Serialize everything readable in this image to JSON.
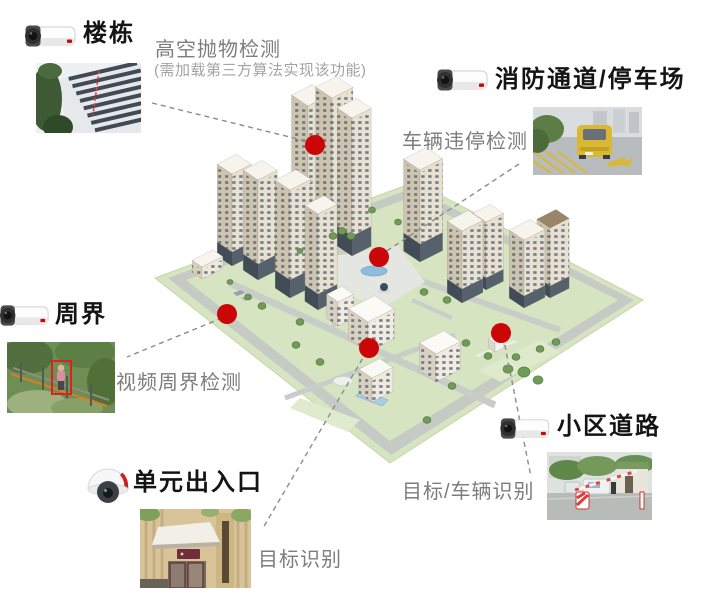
{
  "diagram_title": "智慧小区安防场景示意图",
  "colors": {
    "hotspot": "#cb0606",
    "connector": "#8c8c8c",
    "title_text": "#141414",
    "detection_text": "#7d7d7d",
    "note_text": "#a3a3a3"
  },
  "callouts": [
    {
      "id": "building",
      "title": "楼栋",
      "detection": "高空抛物检测",
      "note": "(需加载第三方算法实现该功能)",
      "camera_icon": "bullet-camera-icon",
      "photo": "building-low-angle-photo"
    },
    {
      "id": "fire-lane-parking",
      "title": "消防通道/停车场",
      "detection": "车辆违停检测",
      "camera_icon": "bullet-camera-icon",
      "photo": "illegal-parking-photo"
    },
    {
      "id": "perimeter",
      "title": "周界",
      "detection": "视频周界检测",
      "camera_icon": "bullet-camera-icon",
      "photo": "fence-intrusion-photo"
    },
    {
      "id": "unit-entrance",
      "title": "单元出入口",
      "detection": "目标识别",
      "camera_icon": "dome-camera-icon",
      "photo": "unit-entrance-photo"
    },
    {
      "id": "community-road",
      "title": "小区道路",
      "detection": "目标/车辆识别",
      "camera_icon": "bullet-camera-icon",
      "photo": "road-barrier-gate-photo"
    }
  ],
  "map": {
    "hotspot_radius": 10,
    "hotspots": [
      {
        "id": "building",
        "x": 315,
        "y": 145
      },
      {
        "id": "fire-lane-parking",
        "x": 379,
        "y": 257
      },
      {
        "id": "perimeter",
        "x": 227,
        "y": 314
      },
      {
        "id": "unit-entrance",
        "x": 369,
        "y": 348
      },
      {
        "id": "community-road",
        "x": 501,
        "y": 333
      }
    ],
    "connectors": [
      {
        "from": "building",
        "x1": 152,
        "y1": 103,
        "x2": 306,
        "y2": 141
      },
      {
        "from": "fire-lane-parking",
        "x1": 519,
        "y1": 164,
        "x2": 382,
        "y2": 254
      },
      {
        "from": "perimeter",
        "x1": 222,
        "y1": 318,
        "x2": 127,
        "y2": 357
      },
      {
        "from": "unit-entrance",
        "x1": 367,
        "y1": 351,
        "x2": 263,
        "y2": 528
      },
      {
        "from": "community-road",
        "x1": 503,
        "y1": 336,
        "x2": 531,
        "y2": 477
      }
    ]
  }
}
